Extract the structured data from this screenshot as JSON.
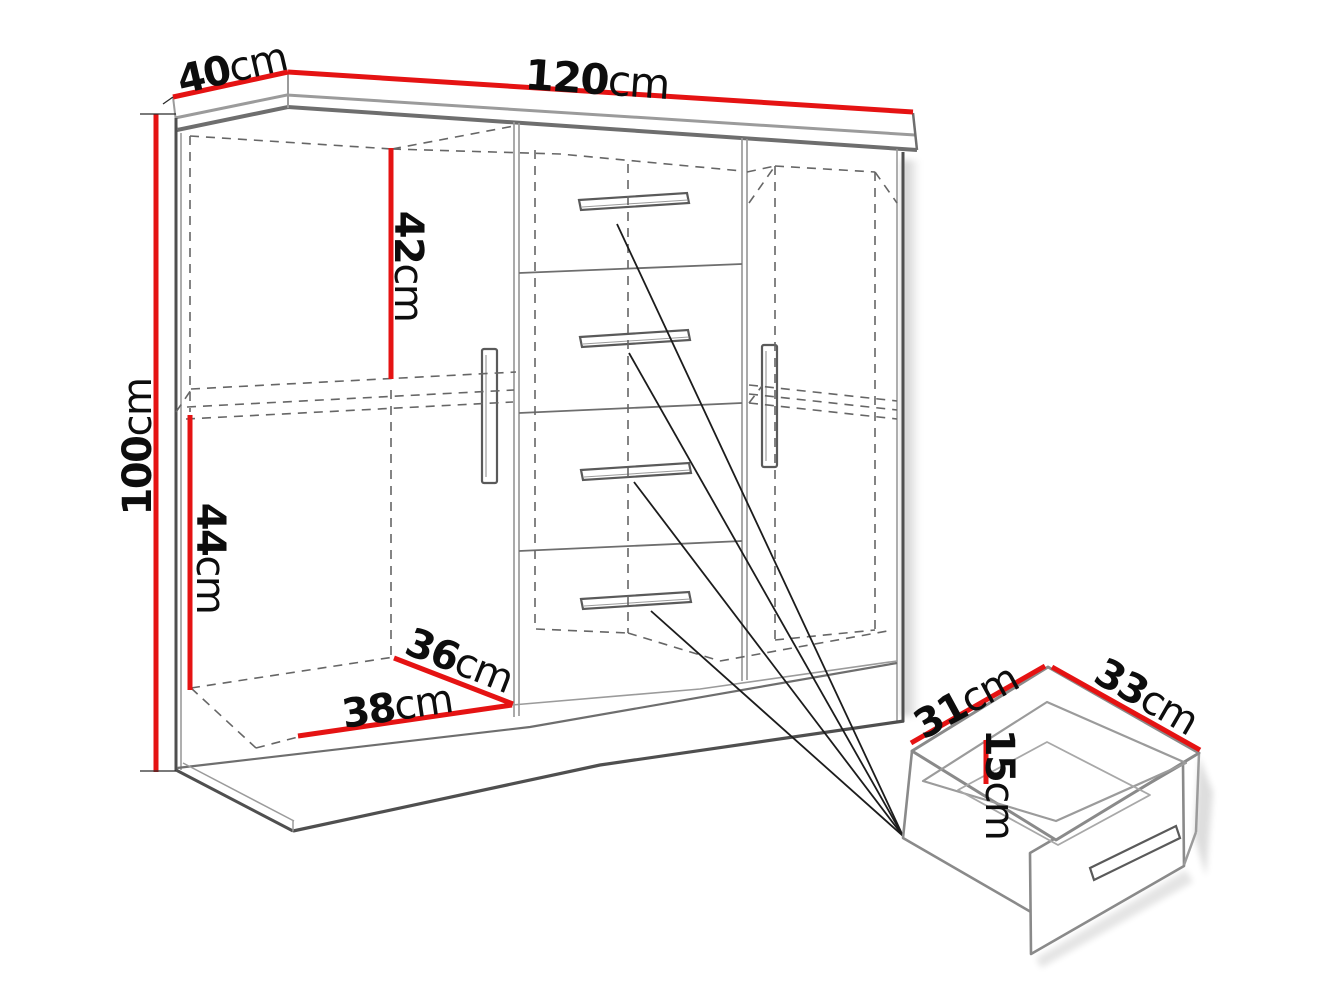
{
  "colors": {
    "dimension_line": "#e51313",
    "structure": "#6e6e6e",
    "hidden_line": "#666666",
    "text": "#0d0d0d",
    "background": "#ffffff"
  },
  "labels": {
    "cabinet": {
      "depth_top": {
        "value": "40",
        "unit": "cm"
      },
      "width_top": {
        "value": "120",
        "unit": "cm"
      },
      "height_left": {
        "value": "100",
        "unit": "cm"
      },
      "upper_section": {
        "value": "42",
        "unit": "cm"
      },
      "lower_section": {
        "value": "44",
        "unit": "cm"
      },
      "inner_depth": {
        "value": "36",
        "unit": "cm"
      },
      "inner_width": {
        "value": "38",
        "unit": "cm"
      }
    },
    "drawer": {
      "depth": {
        "value": "31",
        "unit": "cm"
      },
      "width": {
        "value": "33",
        "unit": "cm"
      },
      "height": {
        "value": "15",
        "unit": "cm"
      }
    }
  }
}
